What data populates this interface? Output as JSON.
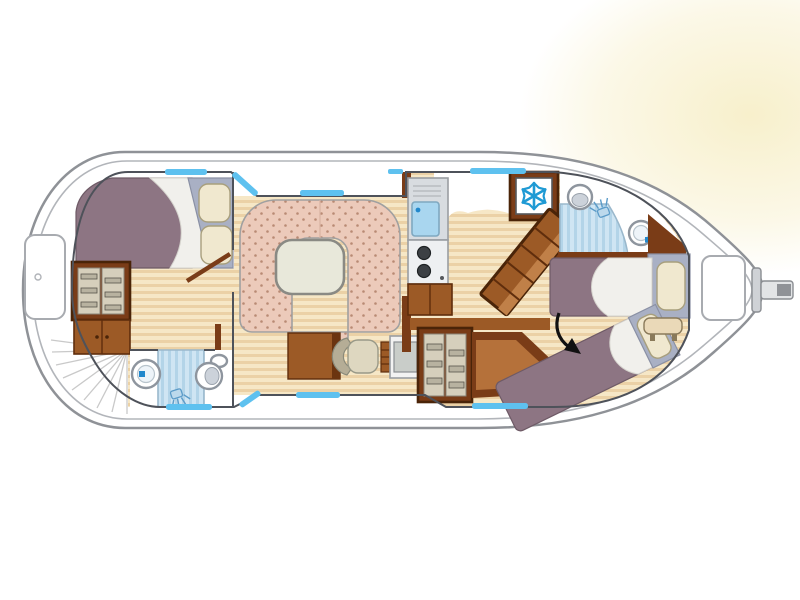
{
  "diagram": {
    "type": "boat-floor-plan",
    "features": [
      "bow deck locker",
      "curved bow steps",
      "double bed cabin",
      "wardrobe",
      "bathroom with sink shower toilet",
      "U-shaped dinette with table",
      "desk with chair",
      "galley with sink and stove",
      "refrigerator",
      "companionway stairs",
      "aft bathroom with shower",
      "two single beds",
      "stern table",
      "stern deck locker",
      "tiller"
    ]
  },
  "icons": [
    {
      "name": "snowflake-icon",
      "color": "#1f9ad4"
    },
    {
      "name": "shower-head-icon",
      "color": "#5b9bc8"
    },
    {
      "name": "direction-arrow-icon",
      "color": "#111111"
    }
  ],
  "palette": {
    "background": "#ffffff",
    "glow": "#f7efc9",
    "hull_fill": "#ffffff",
    "hull_outline": "#8f9297",
    "cabin_outline": "#4e525a",
    "floor_light": "#f6e7c6",
    "floor_dark": "#ebd1a6",
    "wood_dark": "#6b3410",
    "wood_mid": "#9c5a26",
    "wood_frame": "#7a3c17",
    "wood_light": "#b5713a",
    "stair_band": "#c08048",
    "wardrobe_door": "#d6cfbc",
    "bed_duvet": "#8d7583",
    "bed_sheet": "#f1f0ec",
    "pillow": "#f0e8cf",
    "pillow_base": "#a9b0c4",
    "dinette_fabric": "#eccaba",
    "dinette_dot": "#b98a74",
    "table_top": "#e8e8da",
    "window_blue": "#5ec1ef",
    "shower_base": "#cfe5f3",
    "shower_stripe": "#b3d4e8",
    "appliance_gray": "#d8dce0",
    "sink_blue": "#a9d6ef",
    "burner_dark": "#3c4044",
    "snowflake_blue": "#1f9ad4",
    "arrow_black": "#111111",
    "tiller_gray": "#cfd2d6"
  }
}
